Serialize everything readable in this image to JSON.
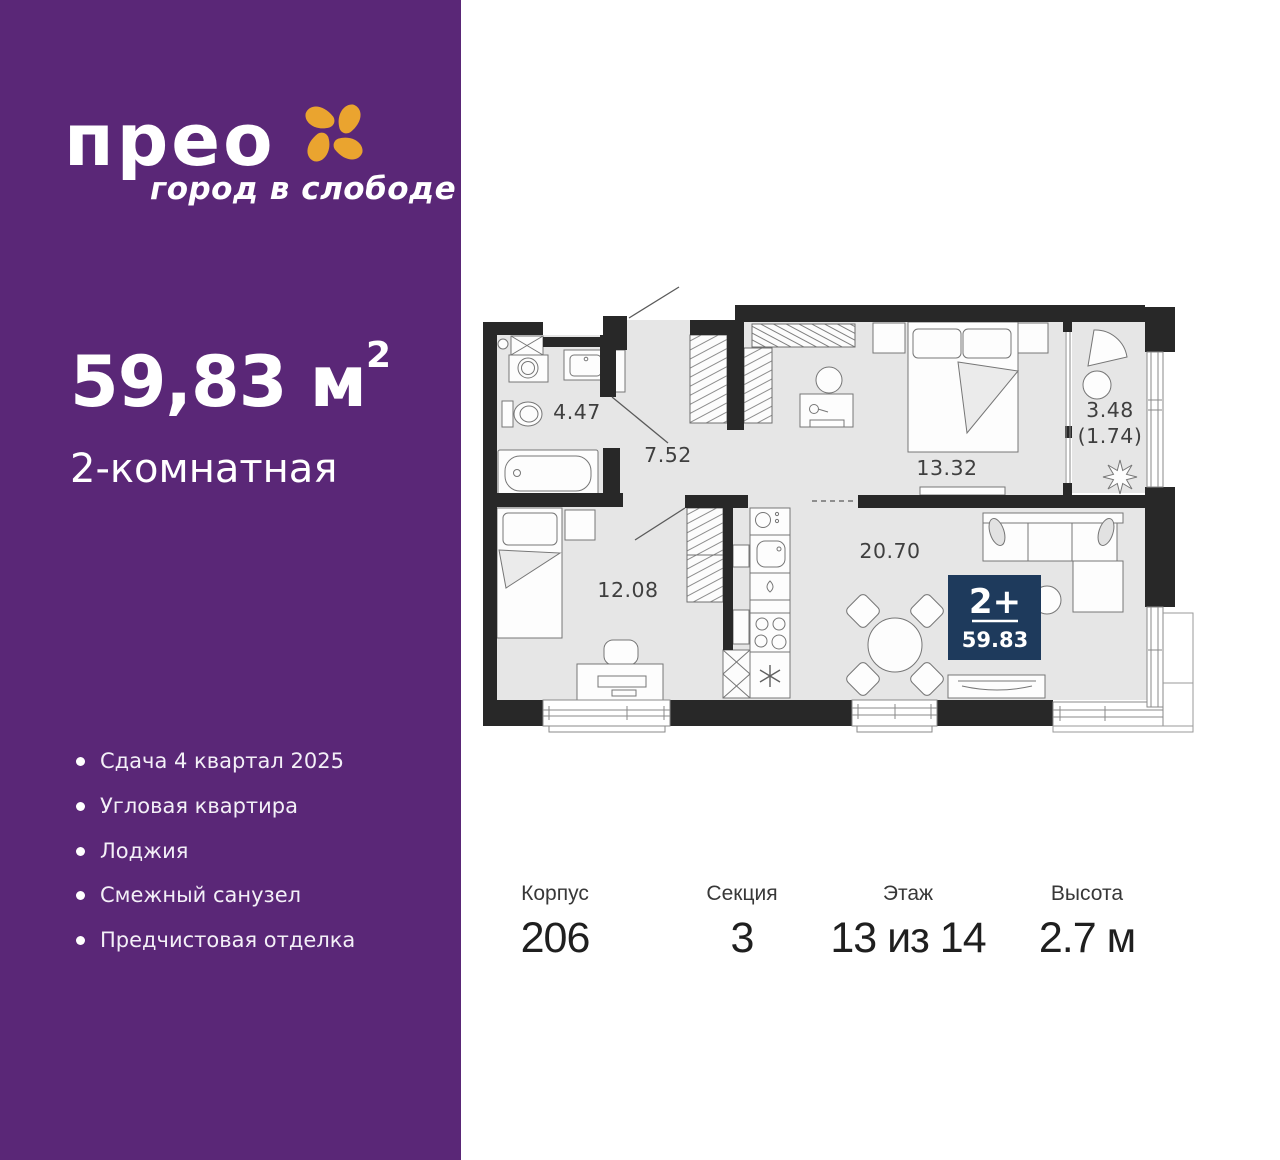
{
  "brand": {
    "logo": "прео",
    "tagline": "город в слободе"
  },
  "apartment": {
    "area_value": "59,83",
    "area_unit": " м",
    "area_superscript": "2",
    "rooms_label": "2-комнатная"
  },
  "features": [
    "Сдача 4 квартал 2025",
    "Угловая квартира",
    "Лоджия",
    "Смежный санузел",
    "Предчистовая отделка"
  ],
  "specs": [
    {
      "label": "Корпус",
      "value": "206"
    },
    {
      "label": "Секция",
      "value": "3"
    },
    {
      "label": "Этаж",
      "value": "13 из 14"
    },
    {
      "label": "Высота",
      "value": "2.7 м"
    }
  ],
  "floor_plan": {
    "badge": {
      "rooms": "2+",
      "area": "59.83"
    },
    "labels": {
      "bathroom": "4.47",
      "hallway": "7.52",
      "bedroom": "13.32",
      "loggia_full": "3.48",
      "loggia_reduced": "(1.74)",
      "second_room": "12.08",
      "kitchen_living": "20.70"
    }
  },
  "colors": {
    "purple": "#5a2777",
    "orange": "#eaa42f",
    "badge_navy": "#1e3a5c",
    "wall": "#282828",
    "floor": "#e6e6e6"
  }
}
